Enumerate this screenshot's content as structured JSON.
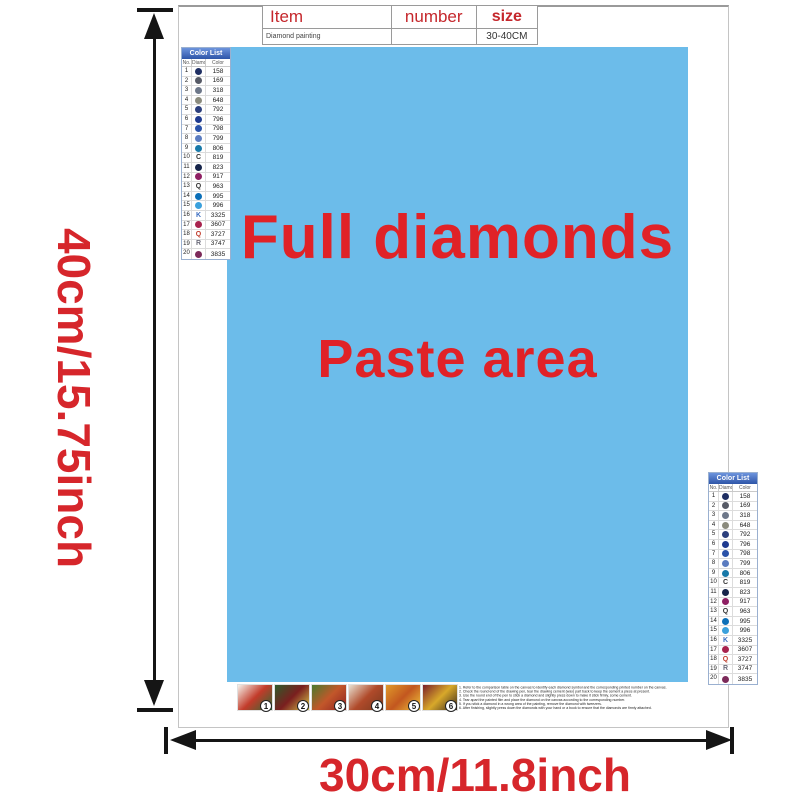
{
  "dimension_labels": {
    "height": "40cm/15.75inch",
    "width": "30cm/11.8inch",
    "color": "#d6262b"
  },
  "item_table": {
    "col1_header": "Item",
    "col2_header": "number",
    "col3_header": "size",
    "row_name": "Diamond painting",
    "row_number": "",
    "row_size": "30-40CM"
  },
  "paste_area": {
    "line1": "Full diamonds",
    "line2": "Paste area",
    "bg": "#6cbcea",
    "text_color": "#e02227"
  },
  "color_list": {
    "title": "Color List",
    "columns": [
      "No.",
      "Diamond",
      "Color"
    ],
    "header_bg": "#3f6cbf",
    "rows": [
      {
        "no": "1",
        "type": "circle",
        "symbol": "●",
        "color": "#1f2f63",
        "code": "158"
      },
      {
        "no": "2",
        "type": "circle",
        "symbol": "●",
        "color": "#565a66",
        "code": "169"
      },
      {
        "no": "3",
        "type": "circle",
        "symbol": "●",
        "color": "#6d7789",
        "code": "318"
      },
      {
        "no": "4",
        "type": "circle",
        "symbol": "●",
        "color": "#8b8b7d",
        "code": "648"
      },
      {
        "no": "5",
        "type": "circle",
        "symbol": "●",
        "color": "#2c3f7d",
        "code": "792"
      },
      {
        "no": "6",
        "type": "circle",
        "symbol": "●",
        "color": "#1f3a8f",
        "code": "796"
      },
      {
        "no": "7",
        "type": "circle",
        "symbol": "●",
        "color": "#2a52a8",
        "code": "798"
      },
      {
        "no": "8",
        "type": "circle",
        "symbol": "●",
        "color": "#5b7cc0",
        "code": "799"
      },
      {
        "no": "9",
        "type": "circle",
        "symbol": "●",
        "color": "#1879a8",
        "code": "806"
      },
      {
        "no": "10",
        "type": "letter",
        "symbol": "C",
        "color": "#333333",
        "code": "819"
      },
      {
        "no": "11",
        "type": "circle",
        "symbol": "●",
        "color": "#16244a",
        "code": "823"
      },
      {
        "no": "12",
        "type": "circle",
        "symbol": "●",
        "color": "#8e1f63",
        "code": "917"
      },
      {
        "no": "13",
        "type": "letter",
        "symbol": "Q",
        "color": "#333333",
        "code": "963"
      },
      {
        "no": "14",
        "type": "circle",
        "symbol": "●",
        "color": "#0b6fb8",
        "code": "995"
      },
      {
        "no": "15",
        "type": "circle",
        "symbol": "●",
        "color": "#3aa0dc",
        "code": "996"
      },
      {
        "no": "16",
        "type": "letter",
        "symbol": "K",
        "color": "#3a6cc0",
        "code": "3325"
      },
      {
        "no": "17",
        "type": "circle",
        "symbol": "●",
        "color": "#a8234e",
        "code": "3607"
      },
      {
        "no": "18",
        "type": "letter",
        "symbol": "Q",
        "color": "#c03a2a",
        "code": "3727"
      },
      {
        "no": "19",
        "type": "letter",
        "symbol": "R",
        "color": "#6b6b7a",
        "code": "3747"
      },
      {
        "no": "20",
        "type": "circle",
        "symbol": "●",
        "color": "#7c2a5a",
        "code": "3835"
      }
    ]
  },
  "steps": [
    {
      "number": "1",
      "colors": [
        "#f5f2ea",
        "#c23b2a",
        "#2e6b34"
      ]
    },
    {
      "number": "2",
      "colors": [
        "#2e5b2a",
        "#7a1f1f",
        "#d8c84a"
      ]
    },
    {
      "number": "3",
      "colors": [
        "#4a7a2e",
        "#c2572a",
        "#8e2323"
      ]
    },
    {
      "number": "4",
      "colors": [
        "#e8e0d0",
        "#b04a2a",
        "#7a3a1f"
      ]
    },
    {
      "number": "5",
      "colors": [
        "#e09a2a",
        "#c2571f",
        "#f0c43a"
      ]
    },
    {
      "number": "6",
      "colors": [
        "#7a1f2a",
        "#d8a82a",
        "#3a2a1f"
      ]
    }
  ],
  "instructions": {
    "lines": [
      "1. Refer to the comparison table on the canvas to identify each diamond symbol and the corresponding printed number on the canvas.",
      "2. Check the round end of the drawing pen, tear the drawing cement (wax) part back to keep the cement a piece at present.",
      "3. Use the round end of the pen to stick a diamond and slightly press down to make it stick firmly, some cement.",
      "4. Tear apart the painted film and place the diamond on the canvas according to the corresponding number.",
      "5. If you stick a diamond in a wrong area of the painting, remove the diamond with tweezers.",
      "6. After finishing, slightly press down the diamonds with your hand or a book to ensure that the diamonds are firmly attached."
    ]
  }
}
